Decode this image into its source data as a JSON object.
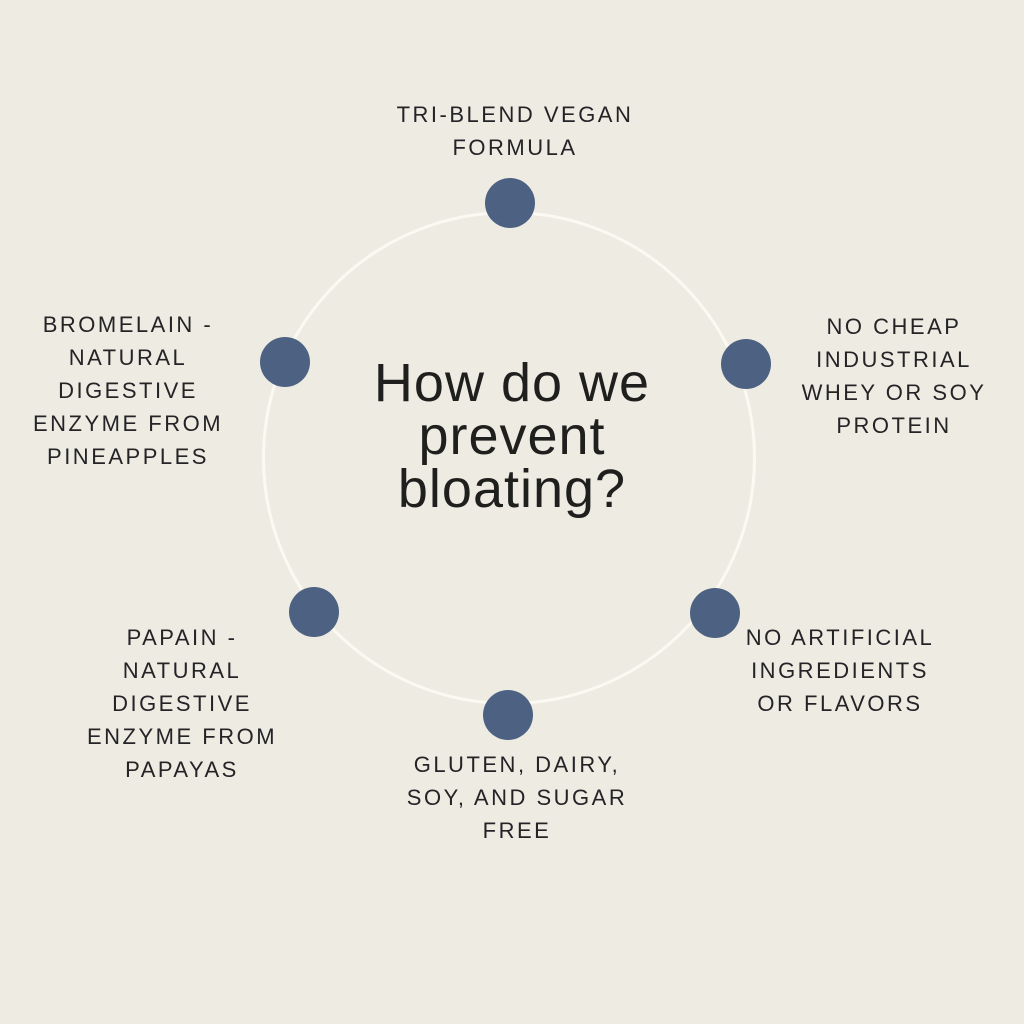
{
  "center_title": "How do we\nprevent\nbloating?",
  "items": [
    {
      "id": "tri-blend",
      "label": "TRI-BLEND VEGAN\nFORMULA"
    },
    {
      "id": "bromelain",
      "label": "BROMELAIN -\nNATURAL\nDIGESTIVE\nENZYME FROM\nPINEAPPLES"
    },
    {
      "id": "no-cheap-whey",
      "label": "NO CHEAP\nINDUSTRIAL\nWHEY OR SOY\nPROTEIN"
    },
    {
      "id": "papain",
      "label": "PAPAIN -\nNATURAL\nDIGESTIVE\nENZYME FROM\nPAPAYAS"
    },
    {
      "id": "no-artificial",
      "label": "NO ARTIFICIAL\nINGREDIENTS\nOR FLAVORS"
    },
    {
      "id": "free-from",
      "label": "GLUTEN, DAIRY,\nSOY, AND SUGAR\nFREE"
    }
  ],
  "colors": {
    "background": "#eeebe3",
    "dot": "#4d6282",
    "ring_outline": "#fbf9f2",
    "text": "#1f1f1e"
  }
}
